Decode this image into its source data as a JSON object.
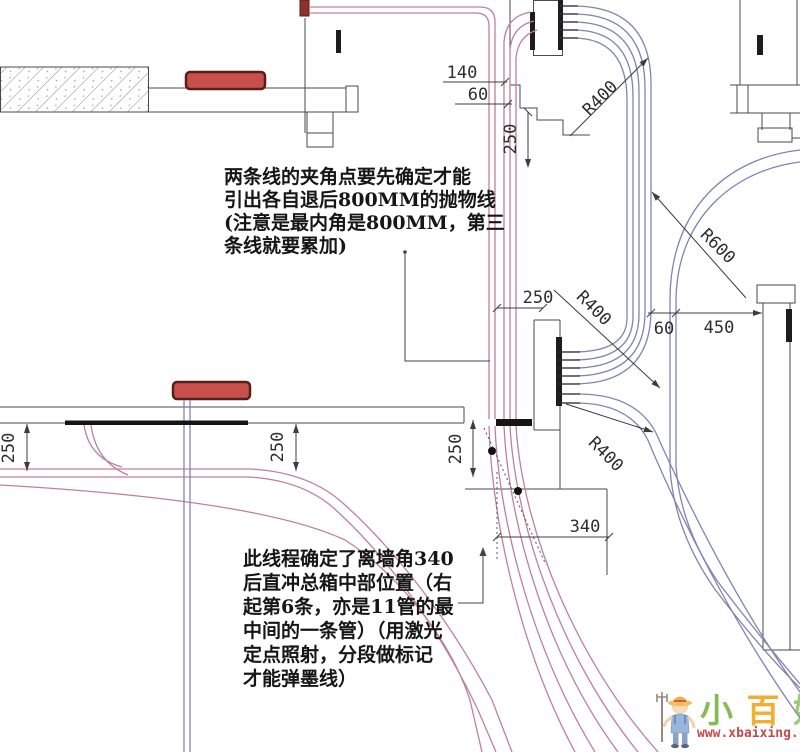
{
  "notes": {
    "note1_lines": [
      "两条线的夹角点要先确定才能",
      "引出各自退后800MM的抛物线",
      "(注意是最内角是800MM，第三",
      "条线就要累加)"
    ],
    "note2_lines": [
      "此线程确定了离墙角340",
      "后直冲总箱中部位置（右",
      "起第6条，亦是11管的最",
      "中间的一条管）（用激光",
      "定点照射，分段做标记",
      "才能弹墨线）"
    ]
  },
  "dimensions": {
    "dim_140": "140",
    "dim_60_top": "60",
    "dim_250_top": "250",
    "dim_r400_top": "R400",
    "dim_r600": "R600",
    "dim_250_mid": "250",
    "dim_r400_mid": "R400",
    "dim_60_mid": "60",
    "dim_450": "450",
    "dim_r400_low": "R400",
    "dim_250_left": "250",
    "dim_250_center": "250",
    "dim_250_right": "250",
    "dim_340": "340"
  },
  "watermark": {
    "char_1": "小",
    "char_2": "百",
    "char_3": "姓",
    "url": "www.xbaixing.com"
  },
  "colors": {
    "conduit_pink": "#c0809a",
    "conduit_blue": "#8282b4",
    "wall_line": "#4a4a4a",
    "dim_line": "#3c3c3c",
    "box_red": "#c8504c",
    "watermark_green": "#7ab648",
    "watermark_orange": "#f2a71f",
    "watermark_url_red": "#c13b3b"
  }
}
